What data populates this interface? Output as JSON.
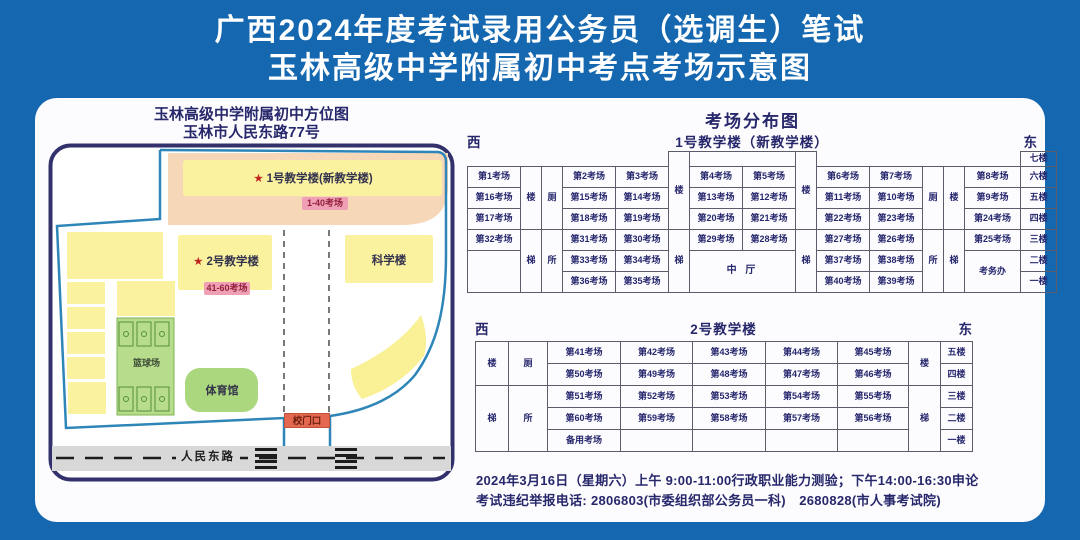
{
  "banner": {
    "line1": "广西2024年度考试录用公务员（选调生）笔试",
    "line2": "玉林高级中学附属初中考点考场示意图"
  },
  "map": {
    "title1": "玉林高级中学附属初中方位图",
    "title2": "玉林市人民东路77号",
    "star": "★",
    "b1_label": "1号教学楼(新教学楼)",
    "b1_range": "1-40考场",
    "b2_label": "2号教学楼",
    "b2_range": "41-60考场",
    "science": "科学楼",
    "basketball": "篮球场",
    "gym": "体育馆",
    "gate": "校门口",
    "road": "人民东路"
  },
  "dist_title": "考场分布图",
  "b1": {
    "west": "西",
    "east": "东",
    "title": "1号教学楼（新教学楼）",
    "floors": [
      "七楼",
      "六楼",
      "五楼",
      "四楼",
      "三楼",
      "二楼",
      "一楼"
    ],
    "stair_u": "楼",
    "stair_d": "梯",
    "wc_u": "厕",
    "wc_d": "所",
    "hall": "中 厅",
    "office": "考务办",
    "colA": [
      "第1考场",
      "第16考场",
      "第17考场",
      "第32考场"
    ],
    "colB": [
      "第2考场",
      "第15考场",
      "第18考场",
      "第31考场",
      "第33考场",
      "第36考场"
    ],
    "colC": [
      "第3考场",
      "第14考场",
      "第19考场",
      "第30考场",
      "第34考场",
      "第35考场"
    ],
    "colD": [
      "第4考场",
      "第13考场",
      "第20考场",
      "第29考场"
    ],
    "colE": [
      "第5考场",
      "第12考场",
      "第21考场",
      "第28考场"
    ],
    "colF": [
      "第6考场",
      "第11考场",
      "第22考场",
      "第27考场",
      "第37考场",
      "第40考场"
    ],
    "colG": [
      "第7考场",
      "第10考场",
      "第23考场",
      "第26考场",
      "第38考场",
      "第39考场"
    ],
    "colH": [
      "第8考场",
      "第9考场",
      "第24考场",
      "第25考场"
    ]
  },
  "b2": {
    "west": "西",
    "east": "东",
    "title": "2号教学楼",
    "floors": [
      "五楼",
      "四楼",
      "三楼",
      "二楼",
      "一楼"
    ],
    "stair_u": "楼",
    "stair_d": "梯",
    "wc_u": "厕",
    "wc_d": "所",
    "rows": [
      [
        "第41考场",
        "第42考场",
        "第43考场",
        "第44考场",
        "第45考场"
      ],
      [
        "第50考场",
        "第49考场",
        "第48考场",
        "第47考场",
        "第46考场"
      ],
      [
        "第51考场",
        "第52考场",
        "第53考场",
        "第54考场",
        "第55考场"
      ],
      [
        "第60考场",
        "第59考场",
        "第58考场",
        "第57考场",
        "第56考场"
      ],
      [
        "备用考场",
        "",
        "",
        "",
        ""
      ]
    ]
  },
  "footer": {
    "line1": "2024年3月16日（星期六）上午 9:00-11:00行政职业能力测验；下午14:00-16:30申论",
    "line2": "考试违纪举报电话: 2806803(市委组织部公务员一科)　2680828(市人事考试院)"
  },
  "colors": {
    "background_blue": "#1568b0",
    "title_white": "#ffffff",
    "navy_text": "#27276b",
    "map_frame_navy": "#32316b",
    "campus_boundary_blue": "#2e86b8",
    "building_yellow": "#fbf2a0",
    "zone_peach": "#f6d7b8",
    "range_label_pink": "#f0a0b4",
    "gate_orange": "#e4684f",
    "sports_green": "#abd77f",
    "road_gray": "#d8d8d8"
  }
}
